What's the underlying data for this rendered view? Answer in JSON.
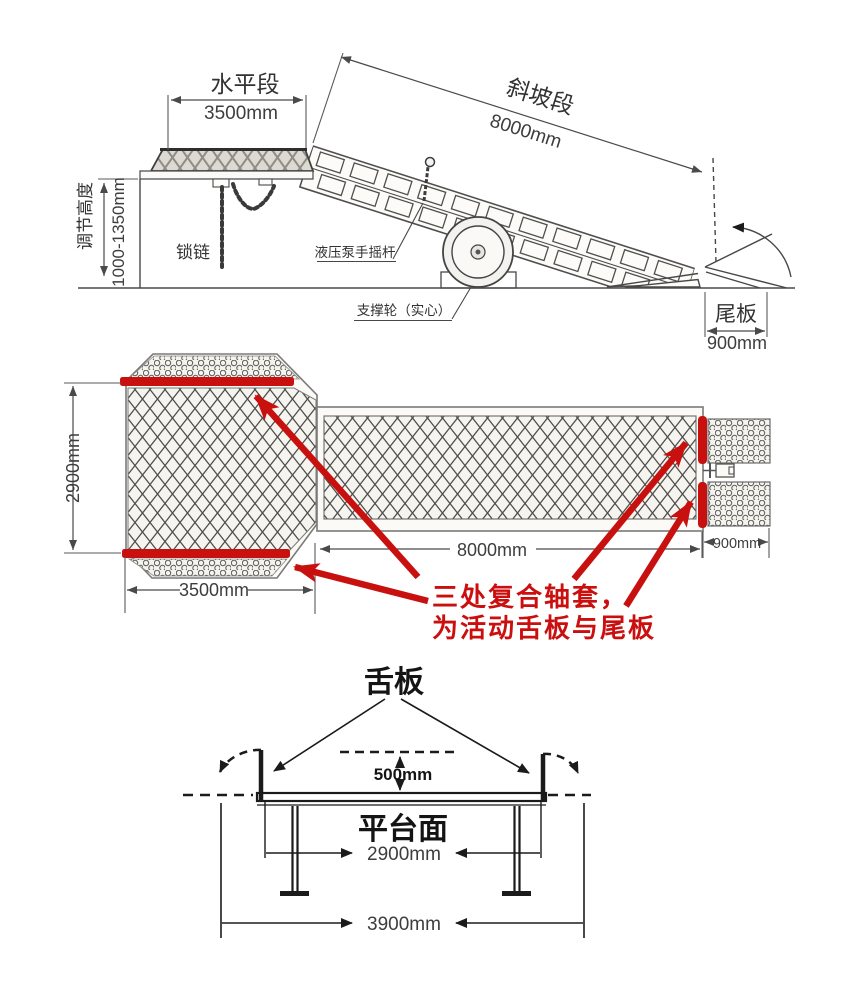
{
  "colors": {
    "accent_red": "#c8100f",
    "line_ink": "#474747",
    "heavy_ink": "#1b1b1b",
    "paper": "#ffffff"
  },
  "side_view": {
    "horizontal_label": "水平段",
    "horizontal_dim": "3500mm",
    "slope_label": "斜坡段",
    "slope_dim": "8000mm",
    "height_label": "调节高度",
    "height_dim": "1000-1350mm",
    "chain_label": "锁链",
    "pump_label": "液压泵手摇杆",
    "wheel_label": "支撑轮（实心）",
    "tail_label": "尾板",
    "tail_dim": "900mm"
  },
  "top_view": {
    "width_dim": "2900mm",
    "platform_dim": "3500mm",
    "ramp_dim": "8000mm",
    "tail_dim": "900mm",
    "note_line1": "三处复合轴套，",
    "note_line2": "为活动舌板与尾板"
  },
  "cross_section": {
    "tongue_label": "舌板",
    "drop_dim": "500mm",
    "platform_label": "平台面",
    "inner_dim": "2900mm",
    "outer_dim": "3900mm"
  }
}
